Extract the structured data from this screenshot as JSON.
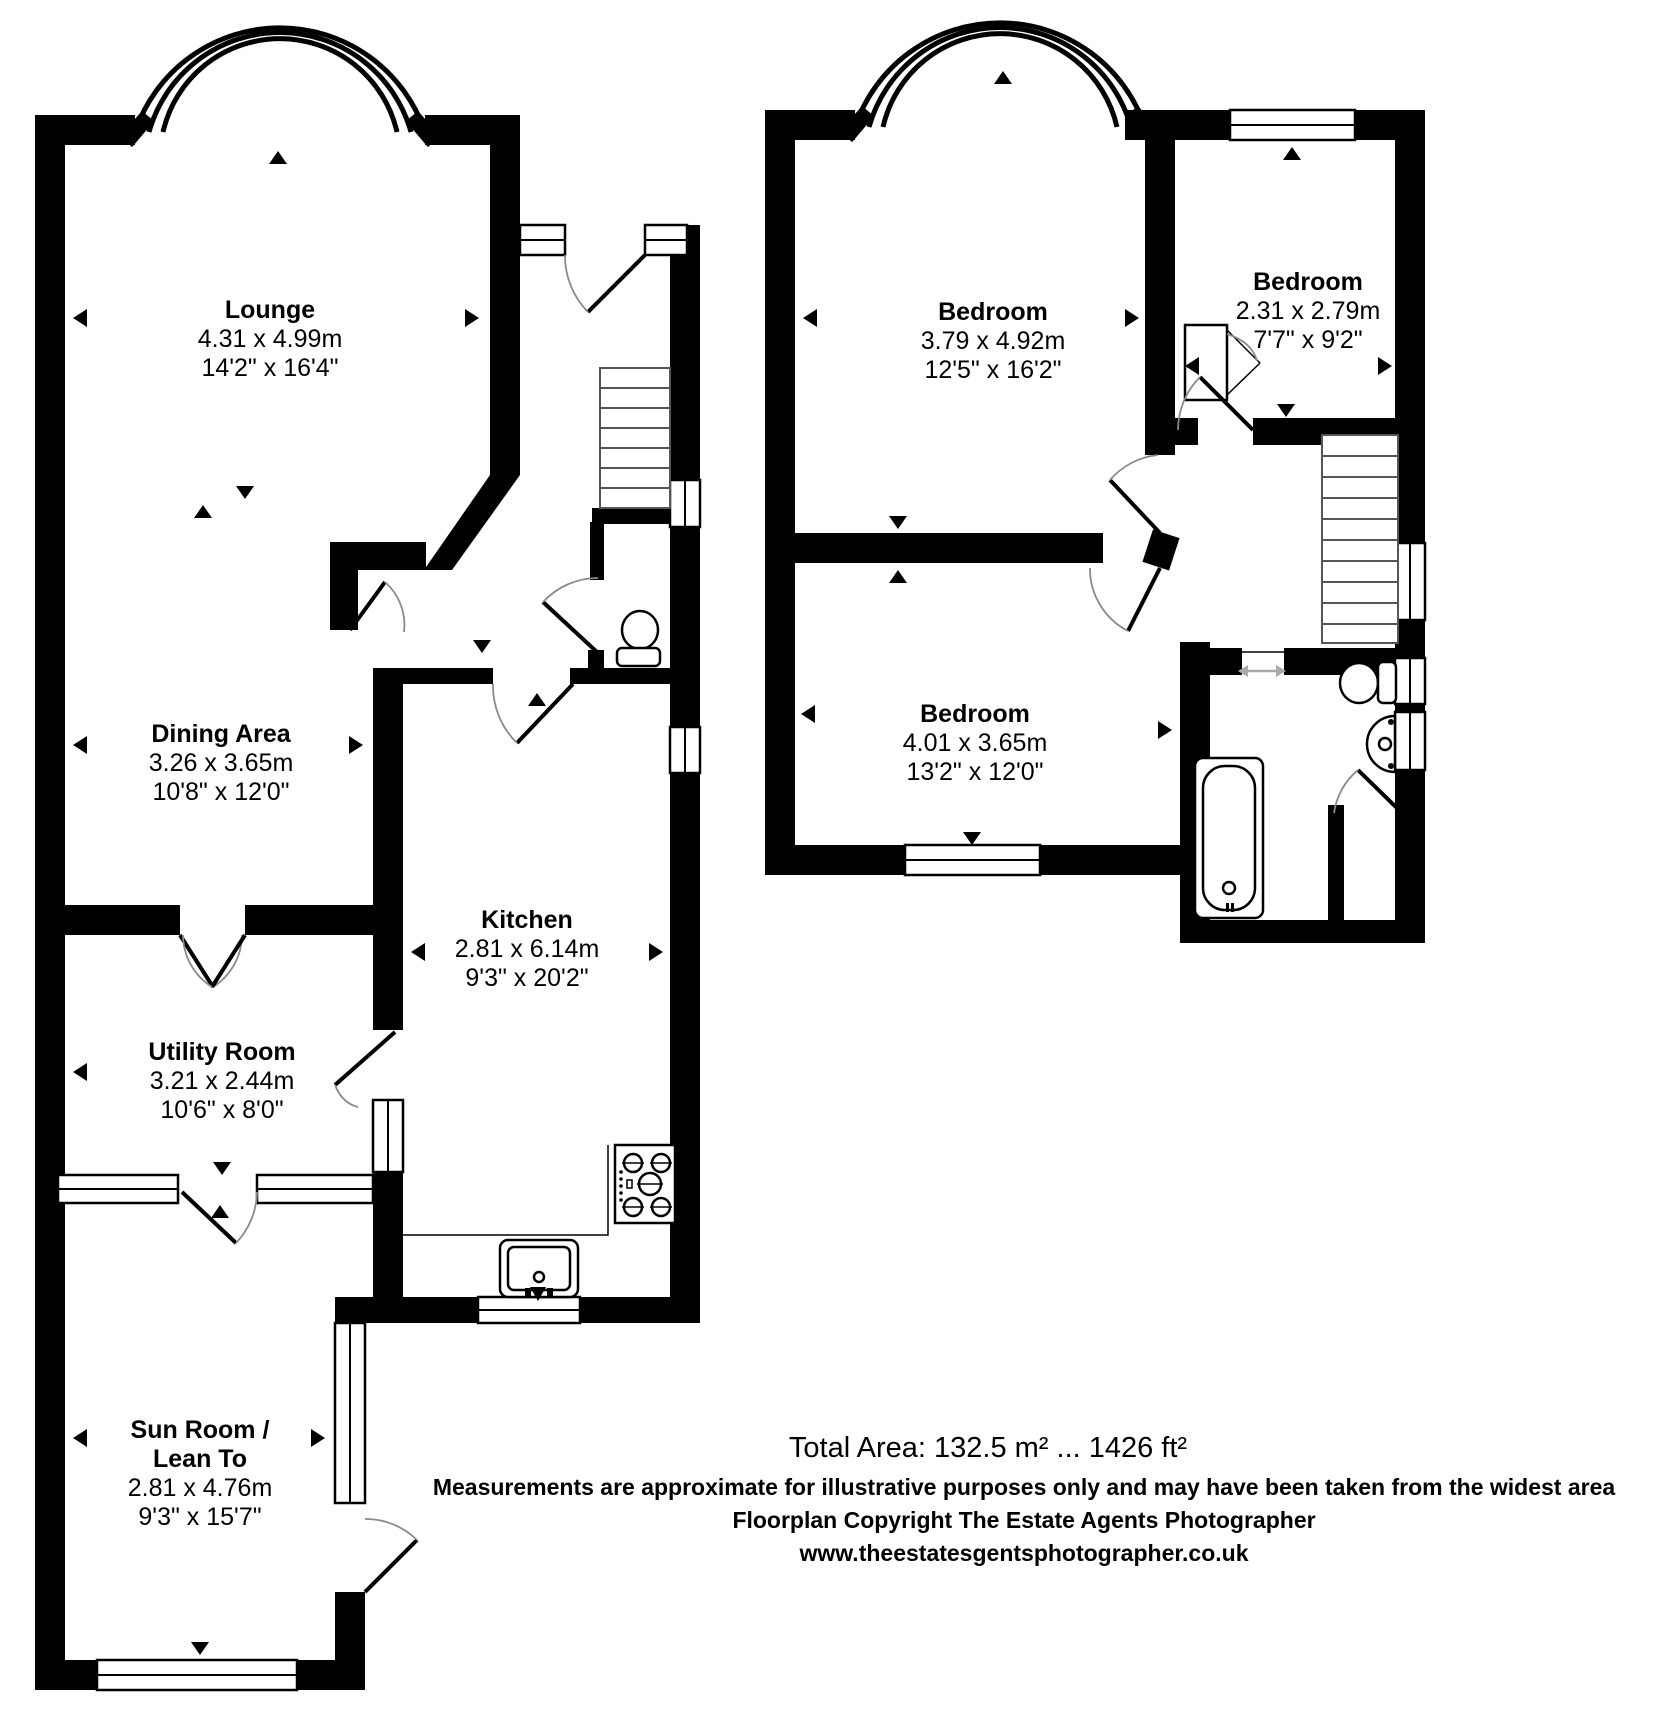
{
  "page": {
    "background": "#ffffff",
    "wall_color": "#000000",
    "door_arc_color": "#8a8a8a",
    "slide_arrow_color": "#aaaaaa"
  },
  "floors": {
    "ground": {
      "rooms": [
        {
          "id": "lounge",
          "name": "Lounge",
          "metric": "4.31 x 4.99m",
          "imperial": "14'2\" x 16'4\""
        },
        {
          "id": "dining",
          "name": "Dining Area",
          "metric": "3.26 x 3.65m",
          "imperial": "10'8\" x 12'0\""
        },
        {
          "id": "kitchen",
          "name": "Kitchen",
          "metric": "2.81 x 6.14m",
          "imperial": "9'3\" x 20'2\""
        },
        {
          "id": "utility",
          "name": "Utility Room",
          "metric": "3.21 x 2.44m",
          "imperial": "10'6\" x 8'0\""
        },
        {
          "id": "sunroom",
          "name": "Sun Room /",
          "name2": "Lean To",
          "metric": "2.81 x 4.76m",
          "imperial": "9'3\" x 15'7\""
        }
      ]
    },
    "first": {
      "rooms": [
        {
          "id": "bedroom1",
          "name": "Bedroom",
          "metric": "3.79 x 4.92m",
          "imperial": "12'5\" x 16'2\""
        },
        {
          "id": "bedroom2",
          "name": "Bedroom",
          "metric": "2.31 x 2.79m",
          "imperial": "7'7\" x 9'2\""
        },
        {
          "id": "bedroom3",
          "name": "Bedroom",
          "metric": "4.01 x 3.65m",
          "imperial": "13'2\" x 12'0\""
        }
      ]
    }
  },
  "footer": {
    "total_area": "Total Area: 132.5 m² ... 1426 ft²",
    "disclaimer": "Measurements are approximate for illustrative purposes only and may have been taken from the widest area",
    "copyright": "Floorplan Copyright The Estate Agents Photographer",
    "website": "www.theestatesgentsphotographer.co.uk"
  }
}
